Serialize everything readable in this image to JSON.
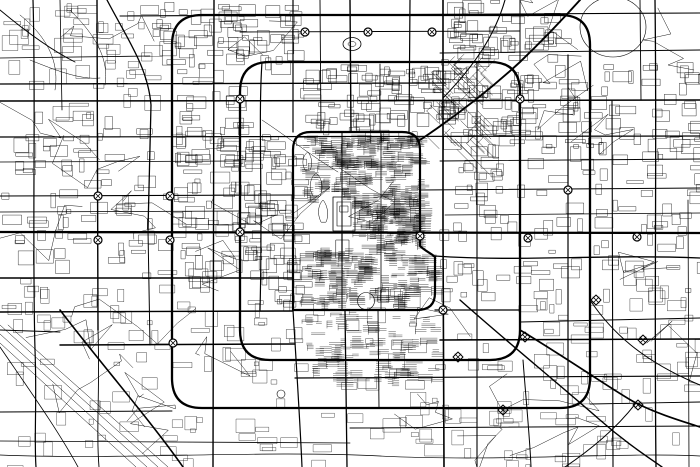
{
  "meta": {
    "kind": "monochrome-street-map",
    "description": "black-and-white city road network map, no labels",
    "background_color": "#ffffff",
    "ink_color": "#000000",
    "canvas": {
      "width": 700,
      "height": 467
    }
  },
  "map": {
    "roads": {
      "arterials": [
        {
          "d": "M120,16 L700,13",
          "w": 1.1
        },
        {
          "d": "M0,58 L150,56",
          "w": 0.8
        },
        {
          "d": "M440,53 L700,50",
          "w": 0.9
        },
        {
          "d": "M0,84 L445,83",
          "w": 1.3
        },
        {
          "d": "M0,101 C200,99 480,102 700,100",
          "w": 1.6
        },
        {
          "d": "M240,32 L520,31",
          "w": 0.9
        },
        {
          "d": "M0,137 L700,136",
          "w": 1.2
        },
        {
          "d": "M440,161 L700,159",
          "w": 0.9
        },
        {
          "d": "M0,162 L240,161",
          "w": 0.8
        },
        {
          "d": "M0,196 L293,195",
          "w": 1.1
        },
        {
          "d": "M420,190 L700,188",
          "w": 1.0
        },
        {
          "d": "M0,212 L240,211",
          "w": 0.8
        },
        {
          "d": "M445,215 L700,213",
          "w": 0.8
        },
        {
          "d": "M0,232 L700,233",
          "w": 2.3
        },
        {
          "d": "M435,256 C520,262 600,254 700,258",
          "w": 1.3
        },
        {
          "d": "M0,278 L293,278",
          "w": 1.5
        },
        {
          "d": "M0,312 L293,311",
          "w": 1.4
        },
        {
          "d": "M435,310 L520,310",
          "w": 1.3
        },
        {
          "d": "M520,322 L700,318",
          "w": 1.0
        },
        {
          "d": "M60,345 L295,344",
          "w": 1.5
        },
        {
          "d": "M0,330 L60,332",
          "w": 0.9
        },
        {
          "d": "M295,378 L700,376",
          "w": 1.2
        },
        {
          "d": "M440,340 L700,339",
          "w": 1.6
        },
        {
          "d": "M0,412 L172,411",
          "w": 0.9
        },
        {
          "d": "M590,404 L700,402",
          "w": 0.9
        },
        {
          "d": "M350,428 L700,426",
          "w": 1.0
        },
        {
          "d": "M0,441 L350,443",
          "w": 0.8
        },
        {
          "d": "M0,455 C120,460 260,450 380,456 C500,462 620,452 700,456",
          "w": 0.7
        },
        {
          "d": "M33,0 C36,100 32,240 35,350 C37,400 34,440 36,467",
          "w": 1.2
        },
        {
          "d": "M60,0 L62,110",
          "w": 0.8
        },
        {
          "d": "M97,0 L98,330",
          "w": 1.4
        },
        {
          "d": "M98,330 C100,390 96,430 99,467",
          "w": 0.9
        },
        {
          "d": "M107,0 C128,40 148,68 151,105 L148,230",
          "w": 1.3
        },
        {
          "d": "M148,230 L150,345",
          "w": 1.0
        },
        {
          "d": "M214,0 L213,467",
          "w": 1.4
        },
        {
          "d": "M262,62 C258,120 263,200 260,310",
          "w": 1.2
        },
        {
          "d": "M293,0 L293,132",
          "w": 1.2
        },
        {
          "d": "M293,310 C296,360 300,420 302,467",
          "w": 1.2
        },
        {
          "d": "M320,0 L321,132",
          "w": 0.9
        },
        {
          "d": "M350,0 L351,132",
          "w": 1.4
        },
        {
          "d": "M342,132 L342,310",
          "w": 1.0
        },
        {
          "d": "M345,310 L347,467",
          "w": 1.3
        },
        {
          "d": "M380,64 L380,132",
          "w": 0.8
        },
        {
          "d": "M381,132 L381,310",
          "w": 0.8
        },
        {
          "d": "M378,310 L379,408",
          "w": 0.9
        },
        {
          "d": "M410,0 L409,132",
          "w": 1.2
        },
        {
          "d": "M443,0 L443,232",
          "w": 1.6
        },
        {
          "d": "M443,232 L444,467",
          "w": 1.6
        },
        {
          "d": "M477,62 L477,467",
          "w": 1.1
        },
        {
          "d": "M520,0 L520,62",
          "w": 1.0
        },
        {
          "d": "M523,360 C526,400 530,440 531,467",
          "w": 1.0
        },
        {
          "d": "M568,55 L568,467",
          "w": 1.2
        },
        {
          "d": "M612,100 L613,467",
          "w": 1.1
        },
        {
          "d": "M640,0 L641,100",
          "w": 0.9
        },
        {
          "d": "M655,0 C657,150 654,300 656,467",
          "w": 1.3
        },
        {
          "d": "M688,200 L689,467",
          "w": 0.8
        },
        {
          "d": "M342,232 L342,262",
          "w": 1.2
        }
      ],
      "rings": [
        {
          "d": "M293,310 L293,150 Q293,132 311,132 L402,132 Q420,132 420,150 L420,246 C425,251 431,253 435,257 L435,293 Q435,310 417,310 Z",
          "w": 2.2
        },
        {
          "d": "M240,92 Q240,62 270,62 L490,62 Q520,62 520,92 L520,330 Q520,360 490,360 L270,360 Q240,360 240,330 Z",
          "w": 2.3
        },
        {
          "d": "M172,45 Q172,15 202,15 L560,15 Q590,15 590,45 L590,378 Q590,408 560,408 L202,408 Q172,408 172,378 Z",
          "w": 2.3
        }
      ],
      "diagonals": [
        {
          "d": "M420,140 C462,112 495,85 520,62 C545,38 562,20 580,0",
          "w": 1.9
        },
        {
          "d": "M443,98 C475,65 495,35 505,0",
          "w": 1.1
        },
        {
          "d": "M460,300 C505,340 560,385 600,420 C625,442 645,455 662,467",
          "w": 1.4
        },
        {
          "d": "M520,330 C570,360 620,395 636,403 C660,415 685,422 700,427",
          "w": 1.7
        },
        {
          "d": "M636,403 C615,430 590,450 565,467",
          "w": 1.0
        },
        {
          "d": "M590,300 C610,330 640,360 700,385",
          "w": 1.0
        },
        {
          "d": "M60,310 C98,360 150,420 183,467",
          "w": 1.6
        },
        {
          "d": "M0,347 C28,388 58,430 78,467",
          "w": 0.8
        },
        {
          "d": "M0,10 C30,35 55,52 75,62",
          "w": 0.9
        },
        {
          "d": "M20,15 C45,35 60,60 55,90",
          "w": 0.5
        },
        {
          "d": "M70,10 C90,30 110,55 105,85",
          "w": 0.5
        },
        {
          "d": "M30,60 C55,70 80,80 100,78",
          "w": 0.5
        }
      ],
      "railways": [
        {
          "d": "M0,325 L158,467",
          "w": 0.5
        },
        {
          "d": "M0,334 L147,467",
          "w": 0.5
        },
        {
          "d": "M8,325 L168,467",
          "w": 0.5
        },
        {
          "d": "M0,343 L136,467",
          "w": 0.5
        },
        {
          "d": "M262,120 C285,135 310,155 338,172",
          "w": 0.5
        }
      ]
    },
    "features": {
      "fills": [
        {
          "name": "west-railway-station",
          "d": "M183,266 L209,267 L209,275 L183,274 Z"
        },
        {
          "name": "moat-river-segment-1",
          "d": "M390,248 L415,250 L415,256 L390,254 Z"
        },
        {
          "name": "moat-river-segment-2",
          "d": "M437,250 L462,252 L462,258 L437,256 Z"
        },
        {
          "name": "moat-river-segment-3",
          "d": "M467,252 L488,253 L488,258 L467,257 Z"
        },
        {
          "name": "north-railway-station",
          "d": "M250,135 L257,133 L261,151 L254,153 Z"
        },
        {
          "name": "south-railway-station",
          "d": "M292,351 L316,342 L325,347 L301,356 Z"
        },
        {
          "name": "northwest-strip",
          "d": "M143,40 L148,40 L149,63 L144,63 Z"
        }
      ],
      "outlines": [
        {
          "name": "forbidden-city-outer-wall",
          "d": "M333,197 h22 v34 h-22 Z",
          "w": 0.8
        },
        {
          "name": "forbidden-city-inner-wall",
          "d": "M337,202 h14 v24 h-14 Z",
          "w": 0.6
        },
        {
          "name": "forbidden-city-hall",
          "d": "M340,206 h8 v6 h-8 Z",
          "w": 0.5
        },
        {
          "name": "tiananmen-square",
          "d": "M336,240 h13 v18 h-13 Z",
          "w": 0.5
        },
        {
          "name": "beihai-lake",
          "d": "M313,196 C308,188 310,178 316,173 C322,178 324,188 320,196 Z",
          "w": 0.5
        },
        {
          "name": "shichahai-lake",
          "d": "M305,170 C301,163 303,155 308,152 C312,157 313,165 310,170 Z",
          "w": 0.5
        },
        {
          "name": "zhongnanhai-lake",
          "d": "M321,222 C317,214 318,205 323,200 C328,206 329,216 326,222 Z",
          "w": 0.5
        },
        {
          "name": "stadium-oval",
          "d": "M343,44 a9,6.5 0 1,0 18,0 a9,6.5 0 1,0 -18,0",
          "w": 0.8
        },
        {
          "name": "stadium-oval-inner",
          "d": "M348,44 a4,2.5 0 1,0 8,0 a4,2.5 0 1,0 -8,0",
          "w": 0.5
        },
        {
          "name": "northeast-circle-park",
          "d": "M580,27 a33,30 0 1,0 66,0 a33,30 0 1,0 -66,0",
          "w": 0.6
        },
        {
          "name": "temple-of-heaven-circle",
          "d": "M357.5,301 a8.5,8.5 0 1,0 17,0 a8.5,8.5 0 1,0 -17,0",
          "w": 0.6
        },
        {
          "name": "southwest-roundabout-park",
          "d": "M277,394 a4,4 0 1,0 8,0 a4,4 0 1,0 -8,0",
          "w": 0.6
        }
      ]
    },
    "interchanges": {
      "circle_radius": 4,
      "circles": [
        [
          305,
          32
        ],
        [
          368,
          32
        ],
        [
          432,
          32
        ],
        [
          240,
          99
        ],
        [
          520,
          99
        ],
        [
          98,
          196
        ],
        [
          170,
          196
        ],
        [
          98,
          240
        ],
        [
          170,
          240
        ],
        [
          240,
          232
        ],
        [
          420,
          236
        ],
        [
          528,
          238
        ],
        [
          637,
          237
        ],
        [
          173,
          343
        ],
        [
          443,
          310
        ],
        [
          568,
          190
        ]
      ],
      "diamonds": [
        [
          525,
          337
        ],
        [
          643,
          340
        ],
        [
          503,
          410
        ],
        [
          638,
          405
        ],
        [
          458,
          357
        ],
        [
          596,
          300
        ]
      ]
    },
    "texture": {
      "seed": 1337,
      "zones": [
        {
          "x": 300,
          "y": 134,
          "w": 118,
          "h": 64,
          "style": "hatch",
          "n": 170,
          "s": 0.35
        },
        {
          "x": 352,
          "y": 198,
          "w": 66,
          "h": 48,
          "style": "hatch",
          "n": 120,
          "s": 0.35
        },
        {
          "x": 300,
          "y": 248,
          "w": 132,
          "h": 58,
          "style": "hatch",
          "n": 140,
          "s": 0.35
        },
        {
          "x": 300,
          "y": 310,
          "w": 135,
          "h": 70,
          "style": "hatch",
          "n": 90,
          "s": 0.33
        },
        {
          "x": 242,
          "y": 134,
          "w": 56,
          "h": 172,
          "style": "rects",
          "n": 90,
          "s": 0.4
        },
        {
          "x": 300,
          "y": 64,
          "w": 140,
          "h": 68,
          "style": "rects",
          "n": 90,
          "s": 0.4
        },
        {
          "x": 150,
          "y": 0,
          "w": 150,
          "h": 62,
          "style": "rects",
          "n": 70,
          "s": 0.4
        },
        {
          "x": 440,
          "y": 0,
          "w": 120,
          "h": 150,
          "style": "rects",
          "n": 130,
          "s": 0.4
        },
        {
          "x": 560,
          "y": 60,
          "w": 140,
          "h": 95,
          "style": "rects",
          "n": 60,
          "s": 0.4
        },
        {
          "x": 425,
          "y": 62,
          "w": 58,
          "h": 92,
          "style": "diag",
          "n": 45,
          "s": 0.45
        },
        {
          "x": 0,
          "y": 0,
          "w": 150,
          "h": 110,
          "style": "rects",
          "n": 55,
          "s": 0.35
        },
        {
          "x": 0,
          "y": 110,
          "w": 240,
          "h": 170,
          "style": "rects",
          "n": 120,
          "s": 0.38
        },
        {
          "x": 440,
          "y": 155,
          "w": 260,
          "h": 140,
          "style": "rects",
          "n": 110,
          "s": 0.38
        },
        {
          "x": 172,
          "y": 62,
          "w": 68,
          "h": 200,
          "style": "rects",
          "n": 70,
          "s": 0.38
        },
        {
          "x": 0,
          "y": 285,
          "w": 700,
          "h": 100,
          "style": "rects",
          "n": 150,
          "s": 0.35
        },
        {
          "x": 0,
          "y": 385,
          "w": 700,
          "h": 82,
          "style": "rects",
          "n": 90,
          "s": 0.33
        }
      ],
      "wander": {
        "count": 28,
        "steps": 6,
        "stroke": 0.45
      },
      "dots": {
        "count": 48,
        "min": 1.5,
        "max": 3.5
      }
    }
  }
}
